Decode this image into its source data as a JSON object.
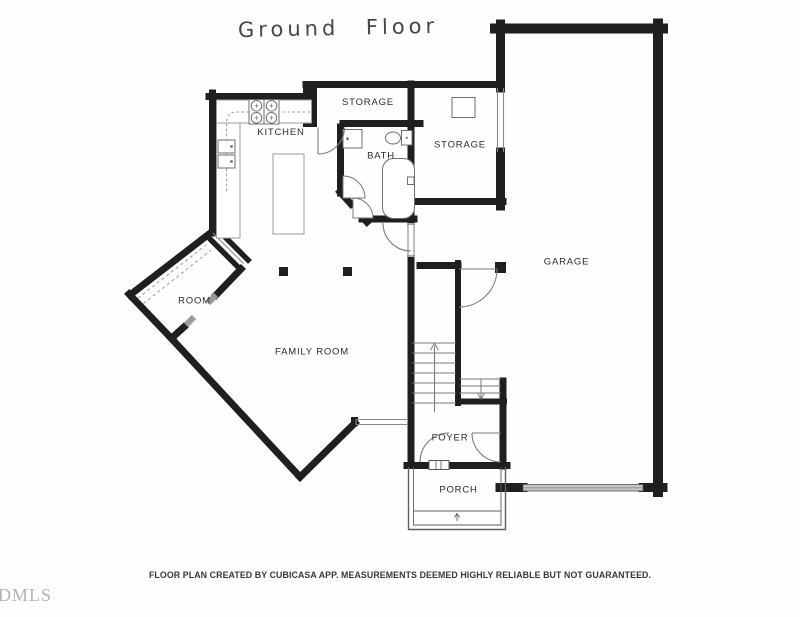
{
  "title": "Ground Floor",
  "watermark": "DMLS",
  "disclaimer": "FLOOR PLAN CREATED BY CUBICASA APP. MEASUREMENTS DEEMED HIGHLY RELIABLE BUT NOT GUARANTEED.",
  "rooms": {
    "kitchen": {
      "label": "KITCHEN"
    },
    "storage_upper": {
      "label": "STORAGE"
    },
    "bath": {
      "label": "BATH"
    },
    "storage_right": {
      "label": "STORAGE"
    },
    "garage": {
      "label": "GARAGE"
    },
    "room": {
      "label": "ROOM"
    },
    "family_room": {
      "label": "FAMILY ROOM"
    },
    "foyer": {
      "label": "FOYER"
    },
    "porch": {
      "label": "PORCH"
    }
  },
  "colors": {
    "wall": "#1f1f1f",
    "fixture_line": "#6f6f6f",
    "counter_line": "#9c9c9c",
    "garage_door": "#c4c4c4",
    "label_text": "#2c2c2c",
    "watermark_text": "#b2b2b2",
    "disclaimer_text": "#383838"
  }
}
